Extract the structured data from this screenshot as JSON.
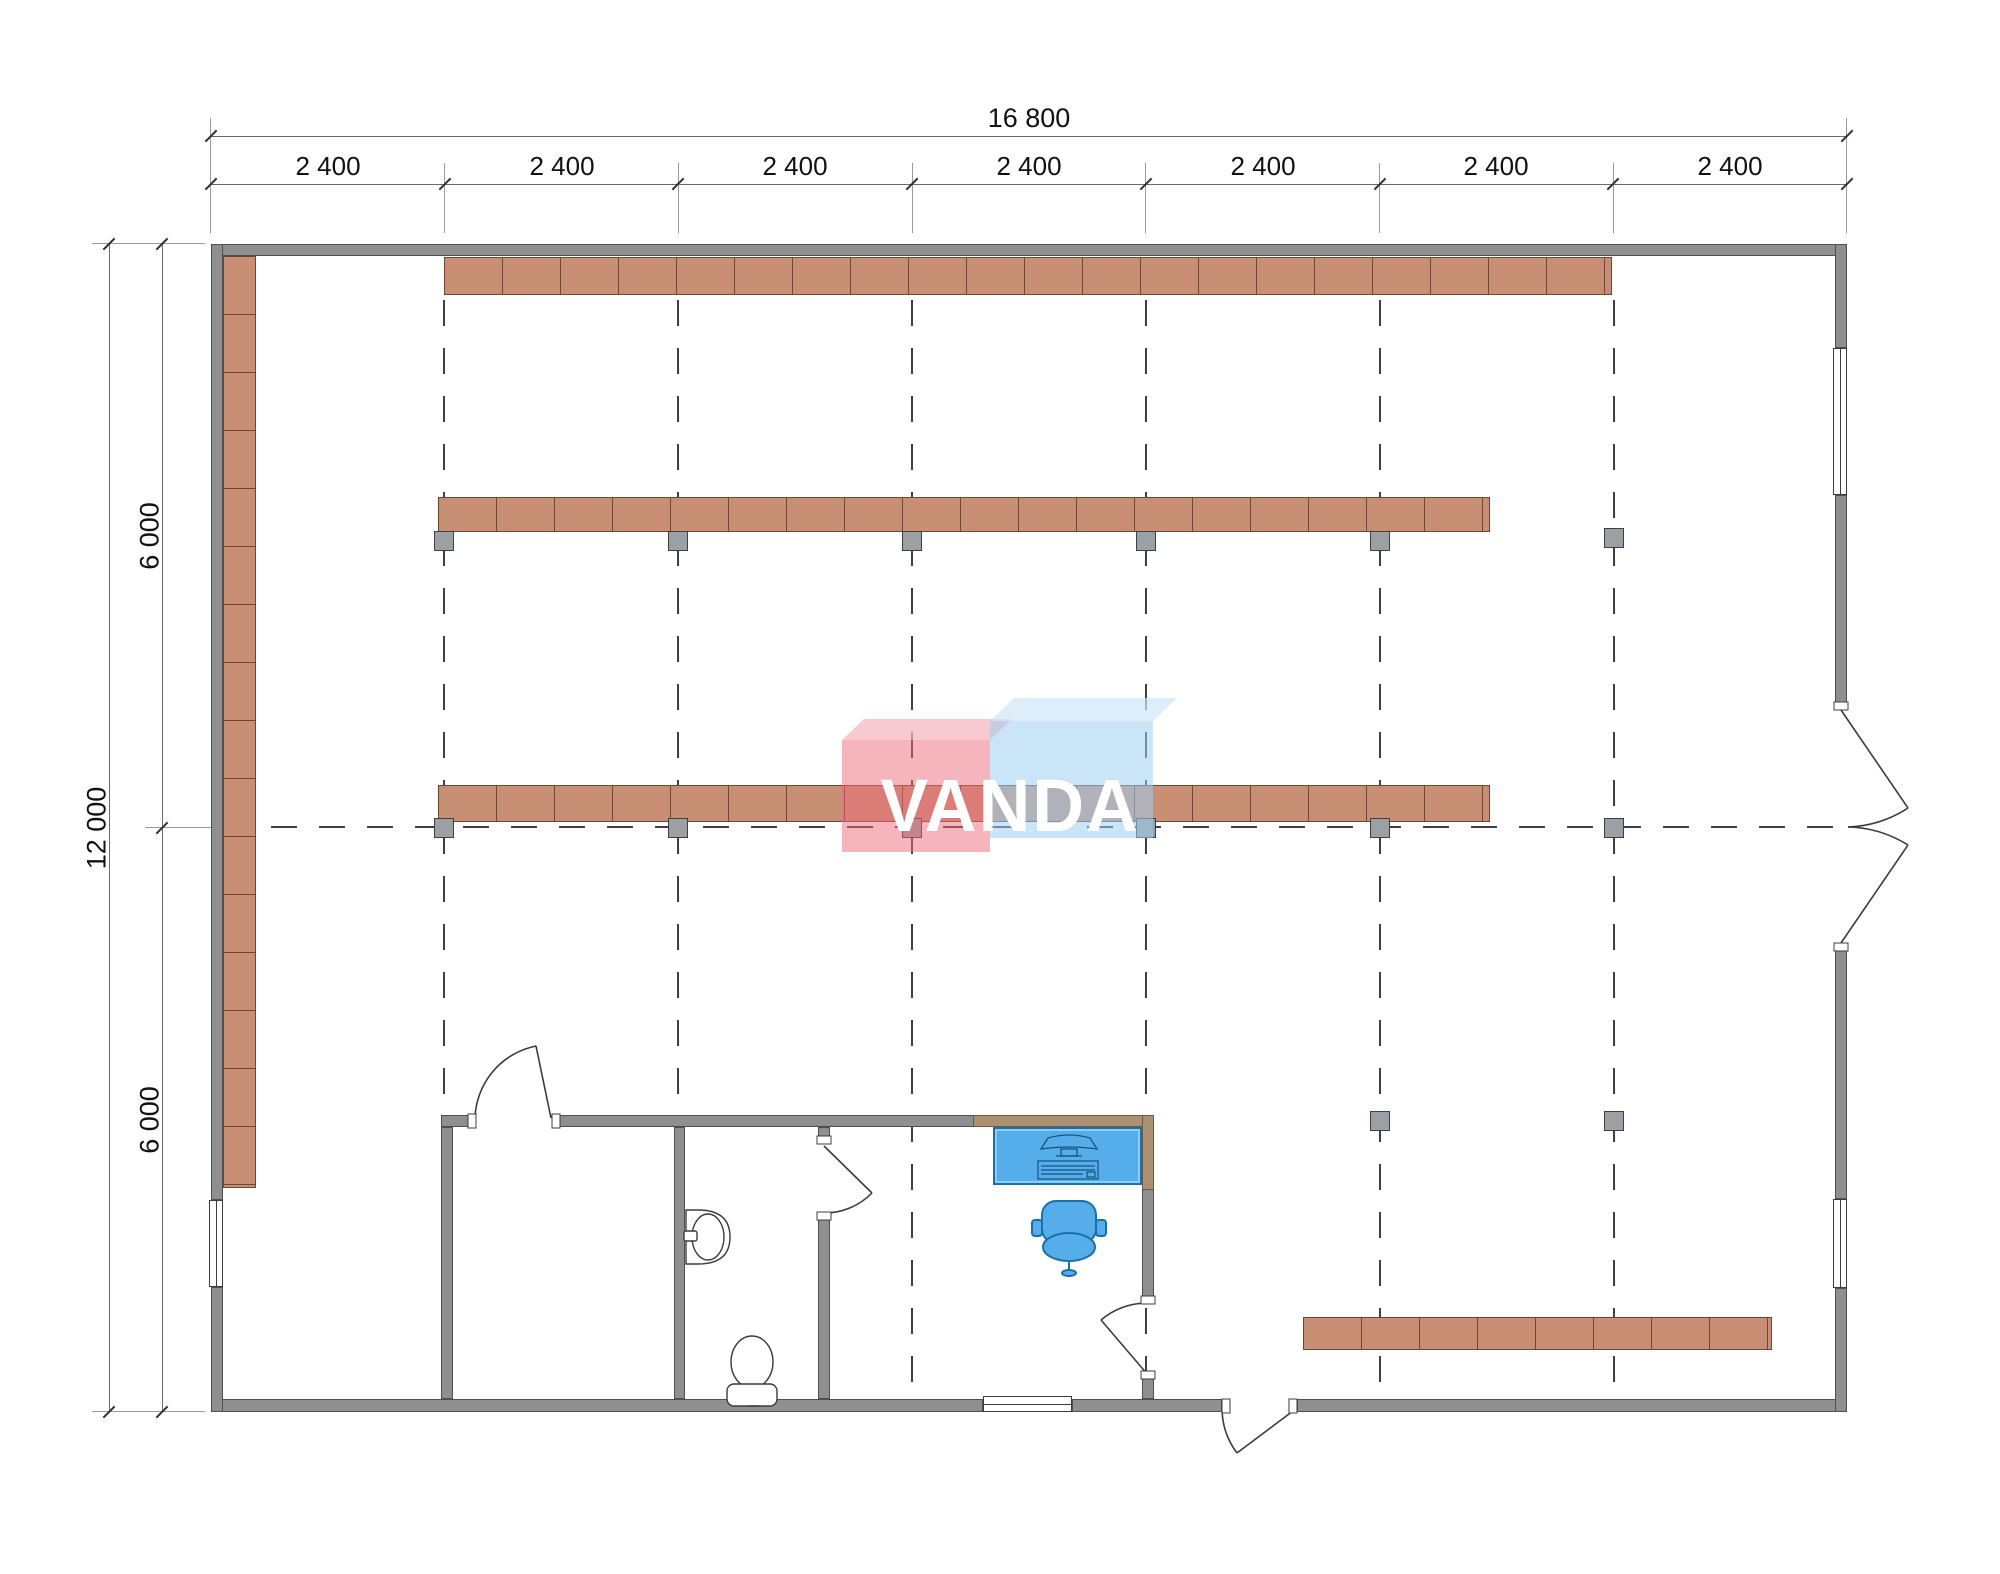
{
  "drawing": {
    "kind": "retail-floor-plan",
    "logo_text": "VANDA",
    "dimensions": {
      "overall_width": "16 800",
      "overall_height": "12 000",
      "top_segments": [
        "2 400",
        "2 400",
        "2 400",
        "2 400",
        "2 400",
        "2 400",
        "2 400"
      ],
      "left_segments": [
        "6 000",
        "6 000"
      ]
    },
    "colors": {
      "wall_gray": "#8f8f8f",
      "wall_tan": "#ab9072",
      "shelf_terracotta": "#c88f75",
      "shelf_border": "#6e4433",
      "furniture_blue": "#55aeea",
      "furniture_blue_border": "#1d6eae",
      "logo_pink": "#ee6476",
      "logo_light_blue": "#9ecef2",
      "line_dark": "#3c3c3c"
    },
    "fixtures": [
      "desk-with-computer",
      "office-chair",
      "sink",
      "toilet"
    ],
    "shelf_rows": 5,
    "grid_columns": 14
  }
}
